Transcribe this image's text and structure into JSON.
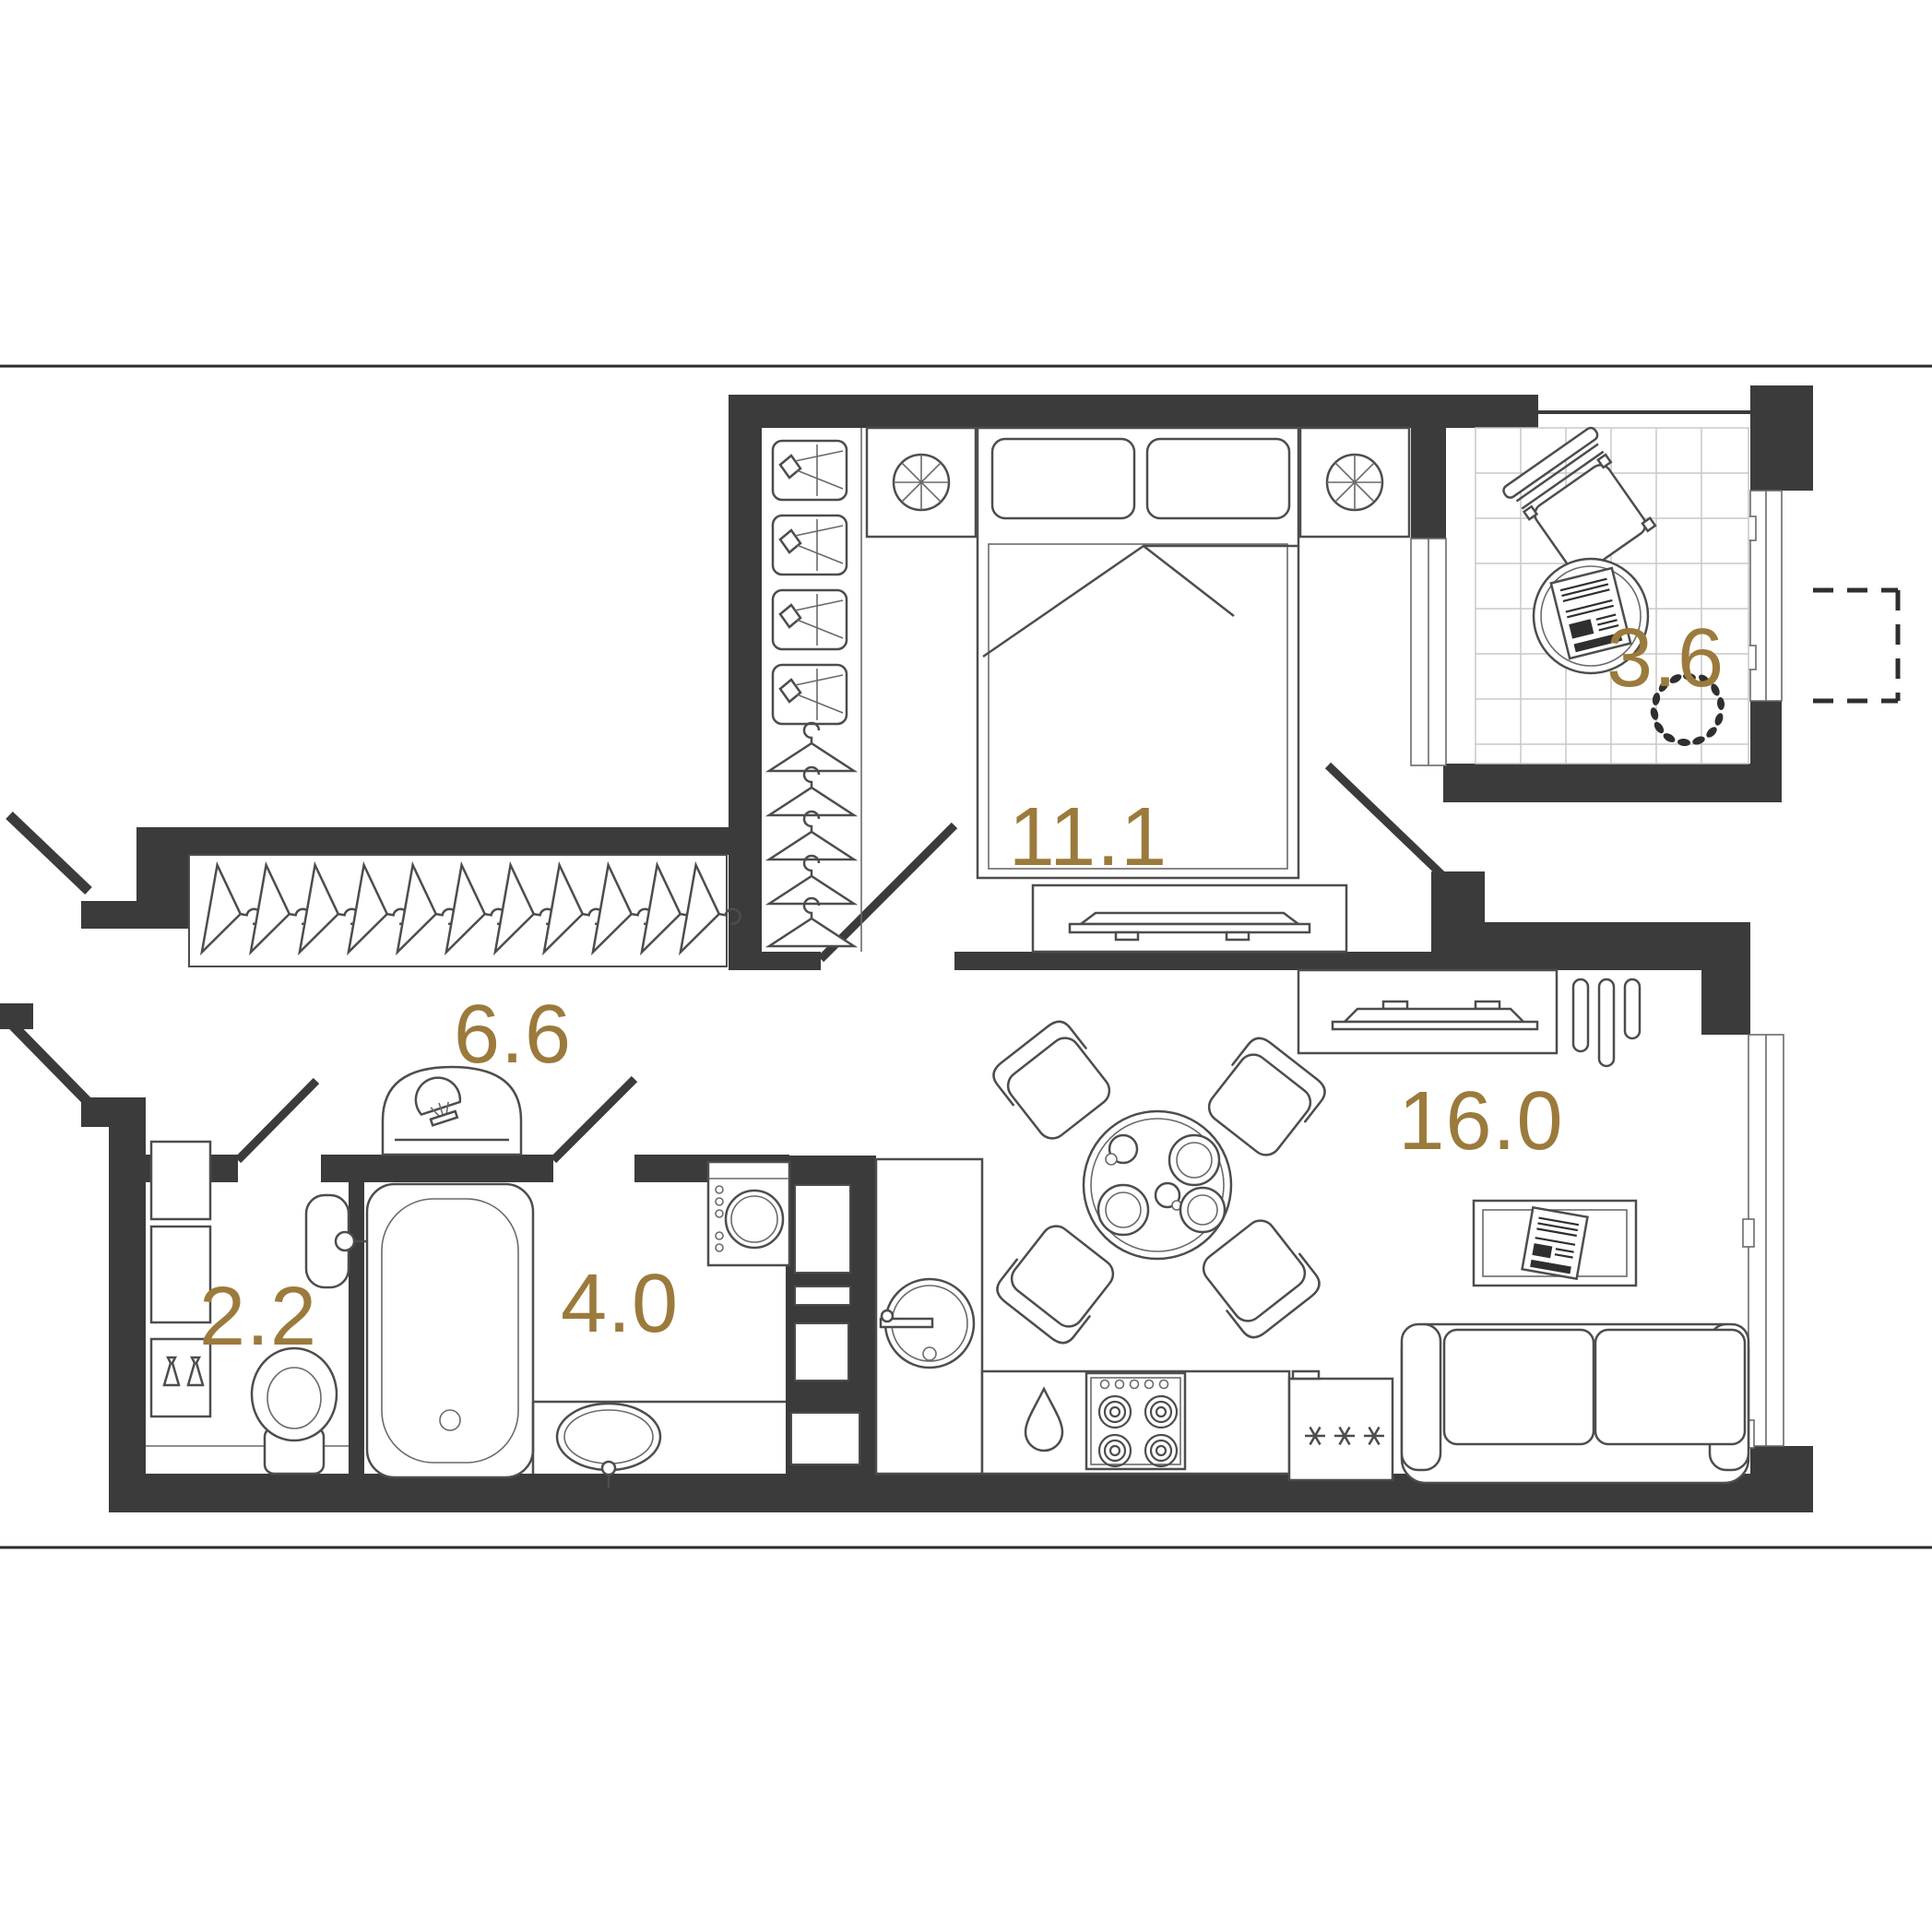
{
  "page": {
    "background": "#ffffff",
    "divider_line_color": "#2a2a2a"
  },
  "palette": {
    "wall_color": "#3b3b3b",
    "furniture_line_color": "#4d4d4d",
    "tile_line_color": "#c9c9c9",
    "accent_gold": "#9b7a3c"
  },
  "floorplan": {
    "room_labels": [
      {
        "id": "bedroom",
        "area": "11.1"
      },
      {
        "id": "balcony",
        "area": "3.6"
      },
      {
        "id": "hallway",
        "area": "6.6"
      },
      {
        "id": "wc",
        "area": "2.2"
      },
      {
        "id": "bathroom",
        "area": "4.0"
      },
      {
        "id": "kitchen-living",
        "area": "16.0"
      }
    ]
  }
}
